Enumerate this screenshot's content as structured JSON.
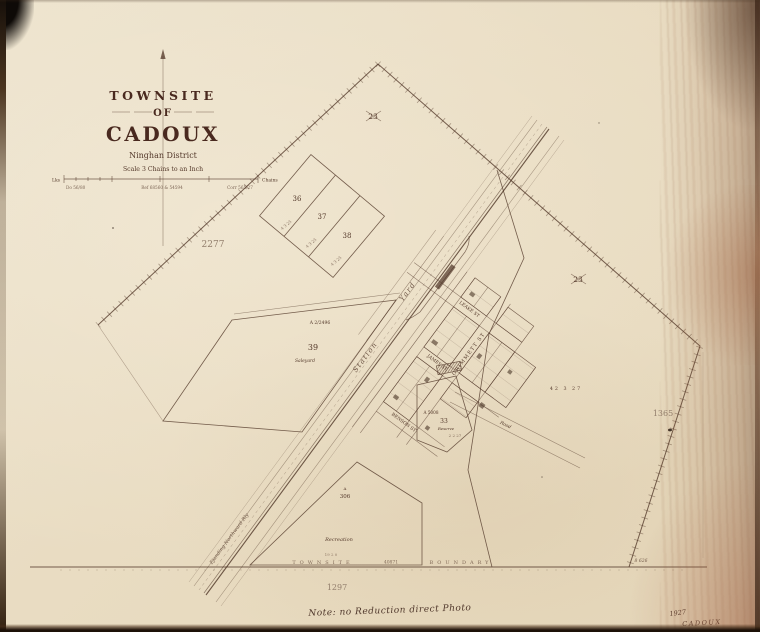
{
  "colors": {
    "ink": "#54392B",
    "paper": "#E9DEC8",
    "faded": "#937F6D"
  },
  "title_block": {
    "line_townsite": "TOWNSITE",
    "line_of": "OF",
    "line_name": "CADOUX",
    "district": "Ninghan District",
    "scale_text": "Scale  3 Chains to an Inch",
    "scale_unit_left": "Lks",
    "scale_unit_right": "Chains",
    "ref_left": "Do 56/80",
    "ref_centre": "Ref 68560 & 54594",
    "ref_right": "Corr 565/27"
  },
  "plan_numbers": {
    "west": "2277",
    "east": "1365",
    "south": "1297"
  },
  "boundary": {
    "word_left": "TOWNSITE",
    "number": "40871",
    "word_right": "BOUNDARY",
    "corner_area": "8 626"
  },
  "lots": {
    "n36": {
      "num": "36",
      "area": "4 3 25"
    },
    "n37": {
      "num": "37",
      "area": "4 3 25"
    },
    "n38": {
      "num": "38",
      "area": "4 3 25"
    },
    "n39": {
      "num": "39",
      "reserve": "A 2/2496",
      "name": "Saleyard"
    },
    "n23_north": {
      "num": "23"
    },
    "n23_east": {
      "num": "23",
      "area": "42 3 27"
    },
    "n33": {
      "num": "33",
      "reserve": "A 5008",
      "name": "Reserve",
      "area": "2 2 27"
    },
    "n306": {
      "num": "306",
      "prefix": "A",
      "name": "Recreation",
      "area": "19 2 0"
    }
  },
  "railway": {
    "station": "Station",
    "yard": "Yard",
    "name": "Ejanding Northward Rly"
  },
  "streets": {
    "grimmett": "GRIMMETT ST",
    "james": "JAMES ST",
    "leake": "LEAKE ST",
    "benson": "BENSON ST",
    "road": "Road"
  },
  "annotations": {
    "note": "Note: no Reduction direct Photo",
    "year": "1927",
    "stamp_name": "CADOUX"
  }
}
